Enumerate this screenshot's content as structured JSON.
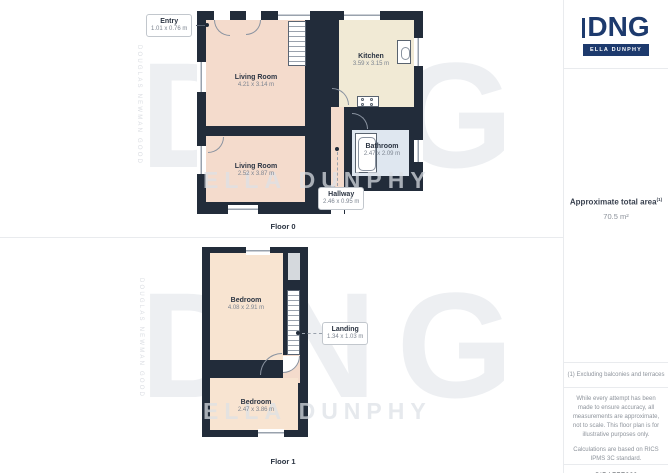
{
  "panels": {
    "floor0": {
      "label": "Floor 0",
      "rooms": {
        "entry": {
          "name": "Entry",
          "dims": "1.01 x 0.76 m"
        },
        "living_top": {
          "name": "Living Room",
          "dims": "4.21 x 3.14 m"
        },
        "kitchen": {
          "name": "Kitchen",
          "dims": "3.59 x 3.15 m"
        },
        "bathroom": {
          "name": "Bathroom",
          "dims": "2.47 x 2.09 m"
        },
        "living_bottom": {
          "name": "Living Room",
          "dims": "2.52 x 3.87 m"
        },
        "hallway": {
          "name": "Hallway",
          "dims": "2.46 x 0.95 m"
        }
      }
    },
    "floor1": {
      "label": "Floor 1",
      "rooms": {
        "bedroom_top": {
          "name": "Bedroom",
          "dims": "4.08 x 2.91 m"
        },
        "landing": {
          "name": "Landing",
          "dims": "1.34 x 1.03 m"
        },
        "bedroom_bottom": {
          "name": "Bedroom",
          "dims": "2.47 x 3.86 m"
        }
      }
    }
  },
  "watermark": {
    "brand": "DNG",
    "agency": "ELLA DUNPHY",
    "vertical_text": "DOUGLAS NEWMAN GOOD"
  },
  "sidebar": {
    "logo": {
      "brand": "DNG",
      "agency": "ELLA DUNPHY"
    },
    "area": {
      "title": "Approximate total area",
      "superscript": "(1)",
      "value": "70.5 m²"
    },
    "note": "(1) Excluding balconies and terraces",
    "disclaimer_line1": "While every attempt has been made to ensure accuracy, all measurements are approximate, not to scale. This floor plan is for illustrative purposes only.",
    "disclaimer_line2": "Calculations are based on RICS IPMS 3C standard.",
    "credit_brand": "GIRAFFE",
    "credit_suffix": "360"
  },
  "colors": {
    "wall": "#222c3a",
    "room_salmon": "#f4dbcc",
    "room_cream": "#f1ead5",
    "room_blue": "#dfe7f0",
    "room_peach": "#f8e4d1",
    "closet_gray": "#d5d9dd",
    "logo_navy": "#1d3a6d"
  }
}
